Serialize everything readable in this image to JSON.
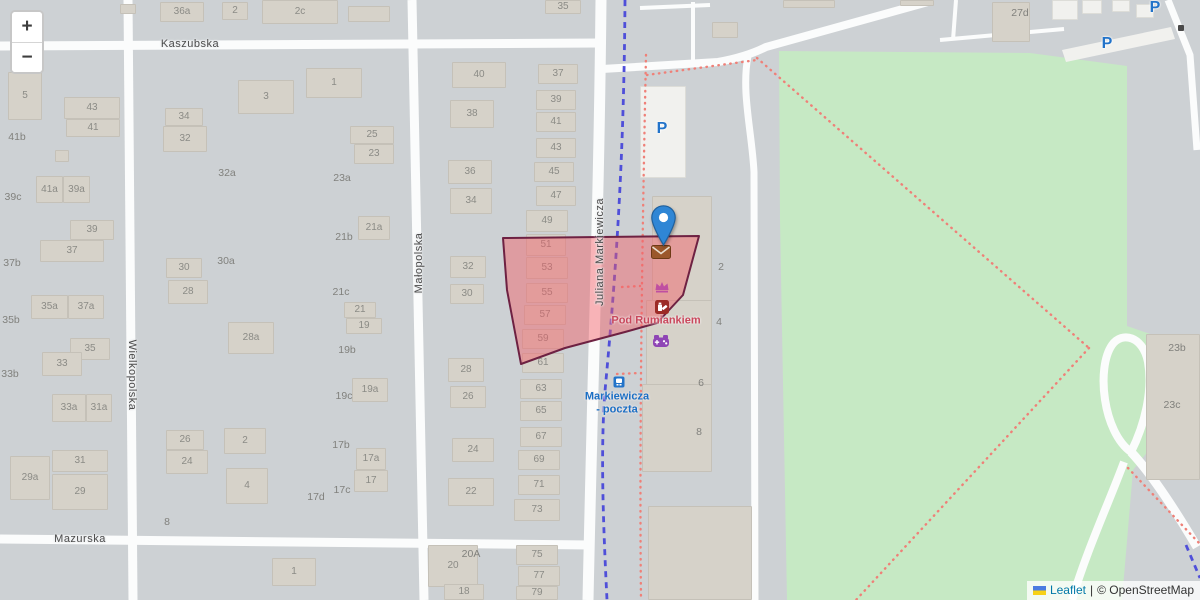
{
  "map": {
    "zoom_control": {
      "zoom_in": "+",
      "zoom_out": "−"
    },
    "attribution": {
      "flag_icon": "ukraine-flag-icon",
      "leaflet_link": "Leaflet",
      "divider": "|",
      "copyright_link": "© OpenStreetMap"
    },
    "streets": [
      {
        "id": "kaszubska",
        "name": "Kaszubska",
        "x": 190,
        "y": 44,
        "rotate": 0
      },
      {
        "id": "mazurska",
        "name": "Mazurska",
        "x": 80,
        "y": 539,
        "rotate": 0
      },
      {
        "id": "wielkopolska",
        "name": "Wielkopolska",
        "x": 132,
        "y": 375,
        "rotate": 90
      },
      {
        "id": "malopolska",
        "name": "Małopolska",
        "x": 419,
        "y": 263,
        "rotate": -90
      },
      {
        "id": "juliana-markiewicza",
        "name": "Juliana Markiewicza",
        "x": 600,
        "y": 252,
        "rotate": -90
      }
    ],
    "pois": [
      {
        "id": "pod-rumiankiem",
        "lines": [
          "Pod Rumiankiem"
        ],
        "x": 656,
        "y": 321,
        "style": "poi-red"
      },
      {
        "id": "bus-stop-name",
        "lines": [
          "Markiewicza",
          "- poczta"
        ],
        "x": 617,
        "y": 403,
        "style": "poi-blue"
      }
    ],
    "icons": [
      {
        "type": "parking",
        "glyph": "P",
        "x": 662,
        "y": 129
      },
      {
        "type": "parking",
        "glyph": "P",
        "x": 1107,
        "y": 44
      },
      {
        "type": "parking",
        "glyph": "P",
        "x": 1155,
        "y": 8
      },
      {
        "type": "bus-stop",
        "x": 619,
        "y": 382
      },
      {
        "type": "post-office",
        "x": 661,
        "y": 252
      },
      {
        "type": "crown",
        "x": 662,
        "y": 287
      },
      {
        "type": "chemist",
        "x": 662,
        "y": 307
      },
      {
        "type": "video-games",
        "x": 661,
        "y": 341
      },
      {
        "type": "gate",
        "x": 1181,
        "y": 28
      }
    ],
    "marker": {
      "x": 663,
      "y": 246
    },
    "area_labels": [
      {
        "x": 17,
        "y": 137,
        "t": "41b"
      },
      {
        "x": 13,
        "y": 197,
        "t": "39c"
      },
      {
        "x": 12,
        "y": 263,
        "t": "37b"
      },
      {
        "x": 11,
        "y": 320,
        "t": "35b"
      },
      {
        "x": 10,
        "y": 374,
        "t": "33b"
      },
      {
        "x": 227,
        "y": 173,
        "t": "32a"
      },
      {
        "x": 226,
        "y": 261,
        "t": "30a"
      },
      {
        "x": 342,
        "y": 178,
        "t": "23a"
      },
      {
        "x": 344,
        "y": 237,
        "t": "21b"
      },
      {
        "x": 341,
        "y": 292,
        "t": "21c"
      },
      {
        "x": 347,
        "y": 350,
        "t": "19b"
      },
      {
        "x": 344,
        "y": 396,
        "t": "19c"
      },
      {
        "x": 341,
        "y": 445,
        "t": "17b"
      },
      {
        "x": 342,
        "y": 490,
        "t": "17c"
      },
      {
        "x": 316,
        "y": 497,
        "t": "17d"
      },
      {
        "x": 167,
        "y": 522,
        "t": "8"
      },
      {
        "x": 471,
        "y": 554,
        "t": "20A"
      },
      {
        "x": 721,
        "y": 267,
        "t": "2"
      },
      {
        "x": 719,
        "y": 322,
        "t": "4"
      },
      {
        "x": 701,
        "y": 383,
        "t": "6"
      },
      {
        "x": 699,
        "y": 432,
        "t": "8"
      },
      {
        "x": 1020,
        "y": 13,
        "t": "27d"
      },
      {
        "x": 1177,
        "y": 348,
        "t": "23b"
      },
      {
        "x": 1172,
        "y": 405,
        "t": "23c"
      }
    ],
    "buildings": [
      {
        "x": 8,
        "y": 72,
        "w": 34,
        "h": 48,
        "label": "5"
      },
      {
        "x": 64,
        "y": 97,
        "w": 56,
        "h": 22,
        "label": "43"
      },
      {
        "x": 66,
        "y": 119,
        "w": 54,
        "h": 18,
        "label": "41"
      },
      {
        "x": 55,
        "y": 150,
        "w": 14,
        "h": 12
      },
      {
        "x": 36,
        "y": 176,
        "w": 27,
        "h": 27,
        "label": "41a"
      },
      {
        "x": 63,
        "y": 176,
        "w": 27,
        "h": 27,
        "label": "39a"
      },
      {
        "x": 70,
        "y": 220,
        "w": 44,
        "h": 20,
        "label": "39"
      },
      {
        "x": 40,
        "y": 240,
        "w": 64,
        "h": 22,
        "label": "37"
      },
      {
        "x": 31,
        "y": 295,
        "w": 37,
        "h": 24,
        "label": "35a"
      },
      {
        "x": 68,
        "y": 295,
        "w": 36,
        "h": 24,
        "label": "37a"
      },
      {
        "x": 70,
        "y": 338,
        "w": 40,
        "h": 22,
        "label": "35"
      },
      {
        "x": 42,
        "y": 352,
        "w": 40,
        "h": 24,
        "label": "33"
      },
      {
        "x": 52,
        "y": 394,
        "w": 34,
        "h": 28,
        "label": "33a"
      },
      {
        "x": 86,
        "y": 394,
        "w": 26,
        "h": 28,
        "label": "31a"
      },
      {
        "x": 52,
        "y": 450,
        "w": 56,
        "h": 22,
        "label": "31"
      },
      {
        "x": 10,
        "y": 456,
        "w": 40,
        "h": 44,
        "label": "29a"
      },
      {
        "x": 52,
        "y": 474,
        "w": 56,
        "h": 36,
        "label": "29"
      },
      {
        "x": 120,
        "y": 4,
        "w": 16,
        "h": 10
      },
      {
        "x": 160,
        "y": 2,
        "w": 44,
        "h": 20,
        "label": "36a"
      },
      {
        "x": 222,
        "y": 2,
        "w": 26,
        "h": 18,
        "label": "2"
      },
      {
        "x": 262,
        "y": 0,
        "w": 76,
        "h": 24,
        "label": "2c"
      },
      {
        "x": 348,
        "y": 6,
        "w": 42,
        "h": 16
      },
      {
        "x": 238,
        "y": 80,
        "w": 56,
        "h": 34,
        "label": "3"
      },
      {
        "x": 306,
        "y": 68,
        "w": 56,
        "h": 30,
        "label": "1"
      },
      {
        "x": 165,
        "y": 108,
        "w": 38,
        "h": 18,
        "label": "34"
      },
      {
        "x": 163,
        "y": 126,
        "w": 44,
        "h": 26,
        "label": "32"
      },
      {
        "x": 166,
        "y": 258,
        "w": 36,
        "h": 20,
        "label": "30"
      },
      {
        "x": 168,
        "y": 280,
        "w": 40,
        "h": 24,
        "label": "28"
      },
      {
        "x": 228,
        "y": 322,
        "w": 46,
        "h": 32,
        "label": "28a"
      },
      {
        "x": 166,
        "y": 430,
        "w": 38,
        "h": 20,
        "label": "26"
      },
      {
        "x": 166,
        "y": 450,
        "w": 42,
        "h": 24,
        "label": "24"
      },
      {
        "x": 224,
        "y": 428,
        "w": 42,
        "h": 26,
        "label": "2"
      },
      {
        "x": 226,
        "y": 468,
        "w": 42,
        "h": 36,
        "label": "4"
      },
      {
        "x": 272,
        "y": 558,
        "w": 44,
        "h": 28,
        "label": "1"
      },
      {
        "x": 350,
        "y": 126,
        "w": 44,
        "h": 18,
        "label": "25"
      },
      {
        "x": 354,
        "y": 144,
        "w": 40,
        "h": 20,
        "label": "23"
      },
      {
        "x": 358,
        "y": 216,
        "w": 32,
        "h": 24,
        "label": "21a"
      },
      {
        "x": 344,
        "y": 302,
        "w": 32,
        "h": 16,
        "label": "21"
      },
      {
        "x": 346,
        "y": 318,
        "w": 36,
        "h": 16,
        "label": "19"
      },
      {
        "x": 352,
        "y": 378,
        "w": 36,
        "h": 24,
        "label": "19a"
      },
      {
        "x": 356,
        "y": 448,
        "w": 30,
        "h": 22,
        "label": "17a"
      },
      {
        "x": 354,
        "y": 470,
        "w": 34,
        "h": 22,
        "label": "17"
      },
      {
        "x": 545,
        "y": 0,
        "w": 36,
        "h": 14,
        "label": "35"
      },
      {
        "x": 452,
        "y": 62,
        "w": 54,
        "h": 26,
        "label": "40"
      },
      {
        "x": 450,
        "y": 100,
        "w": 44,
        "h": 28,
        "label": "38"
      },
      {
        "x": 448,
        "y": 160,
        "w": 44,
        "h": 24,
        "label": "36"
      },
      {
        "x": 450,
        "y": 188,
        "w": 42,
        "h": 26,
        "label": "34"
      },
      {
        "x": 450,
        "y": 256,
        "w": 36,
        "h": 22,
        "label": "32"
      },
      {
        "x": 450,
        "y": 284,
        "w": 34,
        "h": 20,
        "label": "30"
      },
      {
        "x": 448,
        "y": 358,
        "w": 36,
        "h": 24,
        "label": "28"
      },
      {
        "x": 450,
        "y": 386,
        "w": 36,
        "h": 22,
        "label": "26"
      },
      {
        "x": 452,
        "y": 438,
        "w": 42,
        "h": 24,
        "label": "24"
      },
      {
        "x": 448,
        "y": 478,
        "w": 46,
        "h": 28,
        "label": "22"
      },
      {
        "x": 428,
        "y": 545,
        "w": 50,
        "h": 42,
        "label": "20"
      },
      {
        "x": 444,
        "y": 584,
        "w": 40,
        "h": 16,
        "label": "18"
      },
      {
        "x": 538,
        "y": 64,
        "w": 40,
        "h": 20,
        "label": "37"
      },
      {
        "x": 536,
        "y": 90,
        "w": 40,
        "h": 20,
        "label": "39"
      },
      {
        "x": 536,
        "y": 112,
        "w": 40,
        "h": 20,
        "label": "41"
      },
      {
        "x": 536,
        "y": 138,
        "w": 40,
        "h": 20,
        "label": "43"
      },
      {
        "x": 534,
        "y": 162,
        "w": 40,
        "h": 20,
        "label": "45"
      },
      {
        "x": 536,
        "y": 186,
        "w": 40,
        "h": 20,
        "label": "47"
      },
      {
        "x": 526,
        "y": 210,
        "w": 42,
        "h": 22,
        "label": "49"
      },
      {
        "x": 526,
        "y": 234,
        "w": 40,
        "h": 22,
        "label": "51"
      },
      {
        "x": 526,
        "y": 257,
        "w": 42,
        "h": 22,
        "label": "53"
      },
      {
        "x": 526,
        "y": 283,
        "w": 42,
        "h": 20,
        "label": "55"
      },
      {
        "x": 524,
        "y": 305,
        "w": 42,
        "h": 20,
        "label": "57"
      },
      {
        "x": 522,
        "y": 329,
        "w": 42,
        "h": 20,
        "label": "59"
      },
      {
        "x": 522,
        "y": 353,
        "w": 42,
        "h": 20,
        "label": "61"
      },
      {
        "x": 520,
        "y": 379,
        "w": 42,
        "h": 20,
        "label": "63"
      },
      {
        "x": 520,
        "y": 401,
        "w": 42,
        "h": 20,
        "label": "65"
      },
      {
        "x": 520,
        "y": 427,
        "w": 42,
        "h": 20,
        "label": "67"
      },
      {
        "x": 518,
        "y": 450,
        "w": 42,
        "h": 20,
        "label": "69"
      },
      {
        "x": 518,
        "y": 475,
        "w": 42,
        "h": 20,
        "label": "71"
      },
      {
        "x": 514,
        "y": 499,
        "w": 46,
        "h": 22,
        "label": "73"
      },
      {
        "x": 516,
        "y": 545,
        "w": 42,
        "h": 20,
        "label": "75"
      },
      {
        "x": 518,
        "y": 566,
        "w": 42,
        "h": 20,
        "label": "77"
      },
      {
        "x": 516,
        "y": 586,
        "w": 42,
        "h": 14,
        "label": "79"
      },
      {
        "x": 652,
        "y": 196,
        "w": 60,
        "h": 106
      },
      {
        "x": 646,
        "y": 300,
        "w": 66,
        "h": 86
      },
      {
        "x": 642,
        "y": 384,
        "w": 70,
        "h": 88
      },
      {
        "x": 648,
        "y": 506,
        "w": 104,
        "h": 94
      },
      {
        "x": 712,
        "y": 22,
        "w": 26,
        "h": 16
      },
      {
        "x": 640,
        "y": 86,
        "w": 46,
        "h": 92,
        "white": true
      },
      {
        "x": 783,
        "y": 0,
        "w": 52,
        "h": 8
      },
      {
        "x": 900,
        "y": 0,
        "w": 34,
        "h": 6
      },
      {
        "x": 992,
        "y": 2,
        "w": 38,
        "h": 40
      },
      {
        "x": 1052,
        "y": 0,
        "w": 26,
        "h": 20,
        "white": true
      },
      {
        "x": 1082,
        "y": 0,
        "w": 20,
        "h": 14,
        "white": true
      },
      {
        "x": 1112,
        "y": 0,
        "w": 18,
        "h": 12,
        "white": true
      },
      {
        "x": 1136,
        "y": 4,
        "w": 18,
        "h": 14,
        "white": true
      },
      {
        "x": 1146,
        "y": 334,
        "w": 54,
        "h": 146
      }
    ],
    "colors": {
      "background": "#cdd1d4",
      "road": "#fbfcfc",
      "building_fill": "#d6d2c9",
      "building_stroke": "#c5c1b8",
      "park_fill": "#c6e9c4",
      "highlight_fill": "rgba(244,92,100,0.45)",
      "highlight_stroke": "#6e2142",
      "tram_line": "#4f4fd9",
      "footpath_dotted": "#ef8078",
      "marker_blue": "#2f86d5",
      "transport_blue": "#1a6fc4",
      "poi_red": "#c9485c",
      "shop_magenta": "#bf4fa1",
      "amenity_purple": "#8f45b5",
      "post_office_brown": "#9b572b"
    }
  }
}
